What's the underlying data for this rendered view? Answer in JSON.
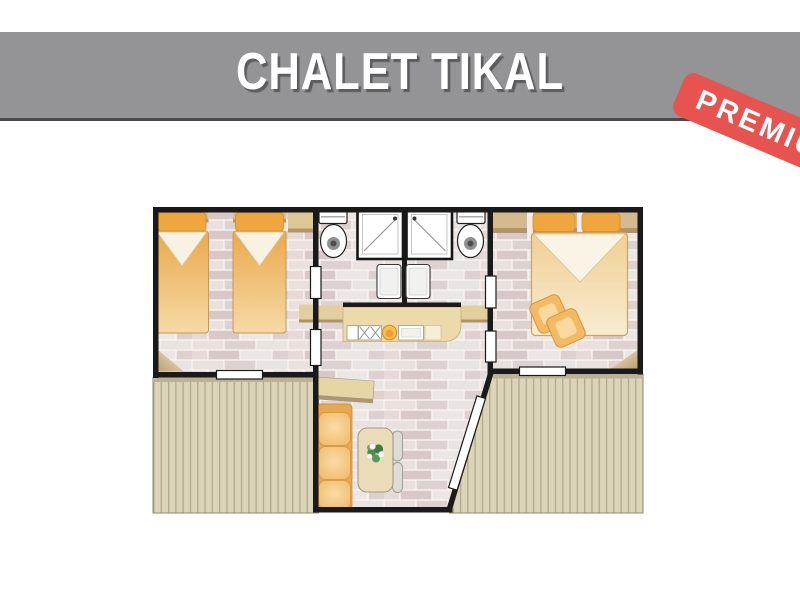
{
  "header": {
    "title": "CHALET TIKAL",
    "bg_color": "#949396",
    "border_color": "#4b4b4d",
    "text_color": "#ffffff",
    "shadow_color": "#5c5c5e"
  },
  "badge": {
    "label": "PREMIUM",
    "visible_text": "PREM",
    "bg_color": "#e7534e",
    "text_color": "#ffffff",
    "rotation_deg": 23
  },
  "floor_plan": {
    "wall_color": "#1a1a1a",
    "tile_color": "#e8e0de",
    "deck_color": "#dbd4b8",
    "furniture_accent_color": "#f0a63e",
    "wood_color": "#e3cf9e",
    "rooms": [
      {
        "name": "twin-bedroom",
        "furniture": [
          "single-bed",
          "single-bed",
          "wardrobe",
          "window"
        ]
      },
      {
        "name": "bathroom-left",
        "furniture": [
          "toilet",
          "shower",
          "washbasin"
        ]
      },
      {
        "name": "bathroom-right",
        "furniture": [
          "toilet",
          "shower",
          "washbasin"
        ]
      },
      {
        "name": "kitchen",
        "furniture": [
          "counter",
          "sink-drainer",
          "fruit-bowl",
          "hob"
        ]
      },
      {
        "name": "master-bedroom",
        "furniture": [
          "double-bed",
          "pillows",
          "cushions",
          "window"
        ]
      },
      {
        "name": "living-area",
        "furniture": [
          "sofa",
          "dining-table",
          "chairs",
          "plant",
          "cabinet",
          "entrance-door"
        ]
      },
      {
        "name": "terrace-left",
        "furniture": []
      },
      {
        "name": "terrace-right",
        "furniture": []
      }
    ]
  }
}
